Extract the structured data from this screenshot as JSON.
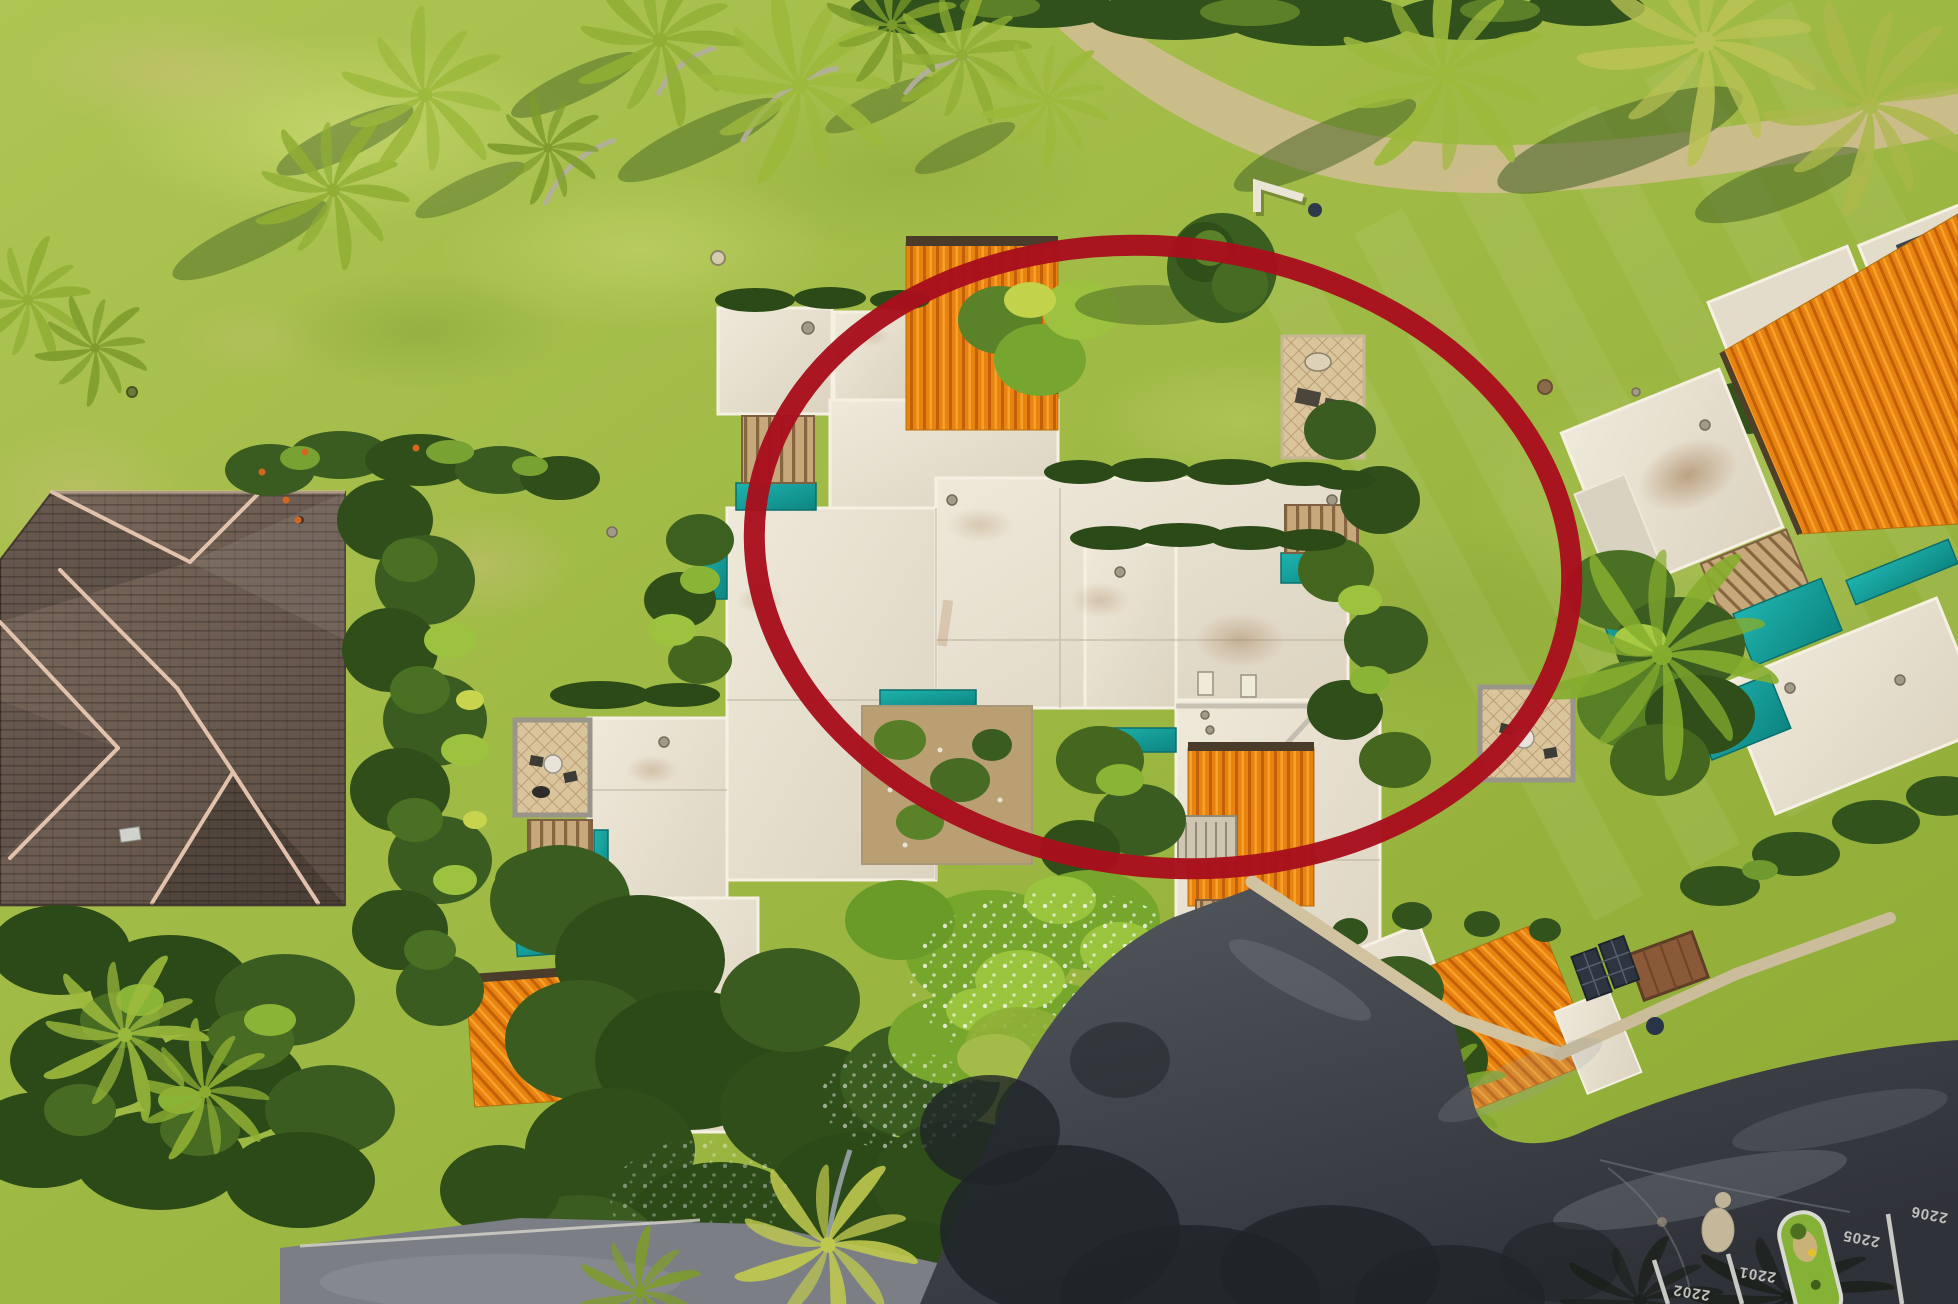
{
  "scene": {
    "description": "Aerial drone photo of a tropical resort condo complex beside a golf course; one roof-top unit is highlighted with a dark red ellipse; parking stalls with painted numbers at bottom right."
  },
  "annotation": {
    "shape": "ellipse",
    "purpose": "highlighted-unit-circle",
    "color": "#a80f1d"
  },
  "parking": {
    "stalls": [
      {
        "label": "2202"
      },
      {
        "label": "2201"
      },
      {
        "label": "2205"
      },
      {
        "label": "2206"
      }
    ]
  },
  "colors": {
    "annotation_red": "#a80f1d",
    "grass": "#9db63e",
    "sand_path": "#cdbd8d",
    "roof_white": "#e8e1d0",
    "roof_orange": "#e8830f",
    "roof_brown": "#6e5d52",
    "awning_teal": "#17a9a4",
    "deck_wood": "#c7a87a",
    "asphalt_dark": "#43474d",
    "asphalt_light": "#7b7f85",
    "parking_paint": "#cbcdc7"
  }
}
